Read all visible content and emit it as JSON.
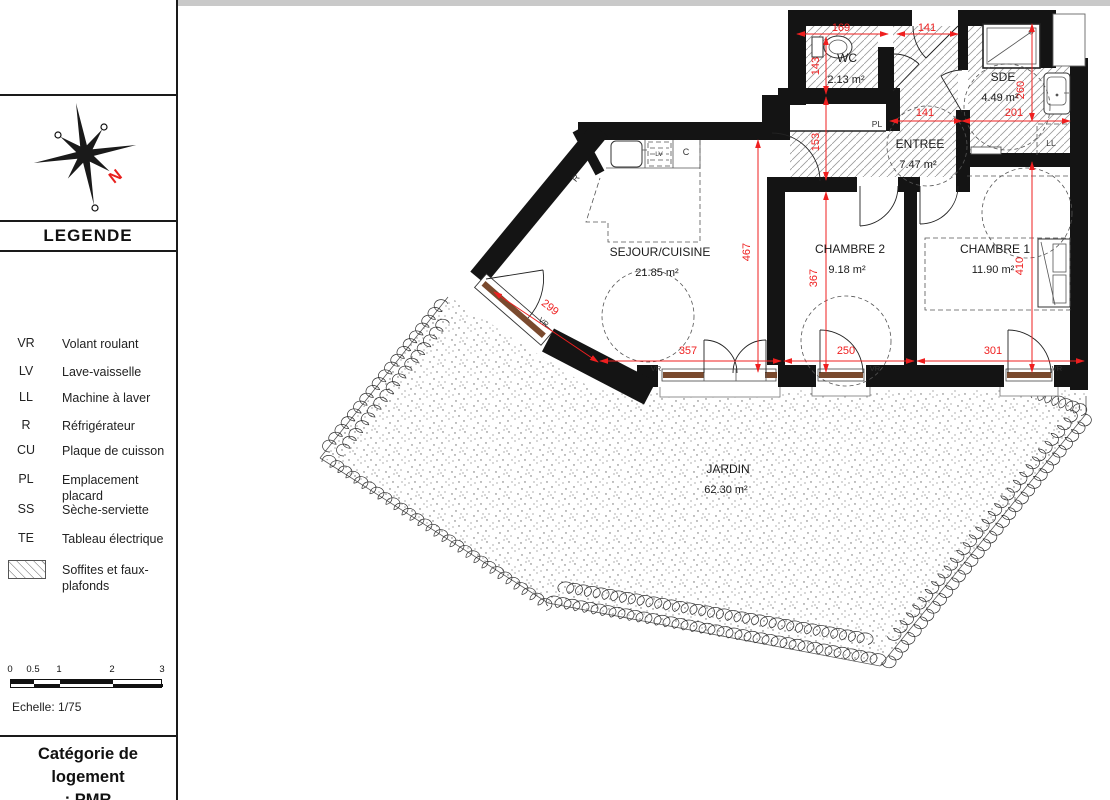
{
  "colors": {
    "dimension_red": "#EF1F1F",
    "wall_black": "#141414",
    "window_frame_brown": "#7A4A2E",
    "hatch_gray": "#999999"
  },
  "sidebar": {
    "legend_title": "LEGENDE",
    "compass_north": "N",
    "items": [
      {
        "abbr": "VR",
        "label": "Volant roulant"
      },
      {
        "abbr": "LV",
        "label": "Lave-vaisselle"
      },
      {
        "abbr": "LL",
        "label": "Machine à laver"
      },
      {
        "abbr": "R",
        "label": "Réfrigérateur"
      },
      {
        "abbr": "CU",
        "label": "Plaque de cuisson"
      },
      {
        "abbr": "PL",
        "label": "Emplacement placard"
      },
      {
        "abbr": "SS",
        "label": "Sèche-serviette"
      },
      {
        "abbr": "TE",
        "label": "Tableau électrique"
      },
      {
        "abbr": "",
        "label": "Soffites et faux-plafonds"
      }
    ],
    "scale": {
      "ticks": [
        "0",
        "0.5",
        "1",
        "2",
        "3"
      ],
      "label": "Echelle: 1/75"
    },
    "category": {
      "line1": "Catégorie de logement",
      "line2": ": PMR"
    }
  },
  "plan": {
    "rooms": {
      "wc": {
        "name": "WC",
        "area": "2.13 m²"
      },
      "sde": {
        "name": "SDE",
        "area": "4.49 m²"
      },
      "entree": {
        "name": "ENTREE",
        "area": "7.47 m²"
      },
      "sejour": {
        "name": "SEJOUR/CUISINE",
        "area": "21.85 m²"
      },
      "chambre2": {
        "name": "CHAMBRE 2",
        "area": "9.18 m²"
      },
      "chambre1": {
        "name": "CHAMBRE 1",
        "area": "11.90 m²"
      },
      "jardin": {
        "name": "JARDIN",
        "area": "62.30 m²"
      }
    },
    "dims": {
      "d169": "169",
      "d141a": "141",
      "d141b": "141",
      "d201": "201",
      "d143": "143",
      "d153": "153",
      "d260": "260",
      "d410": "410",
      "d467": "467",
      "d367": "367",
      "d299": "299",
      "d357": "357",
      "d250": "250",
      "d301": "301"
    },
    "tags": {
      "vr": "VR",
      "pl": "PL",
      "ll": "LL",
      "lv": "LV",
      "cu": "C",
      "r": "R"
    }
  }
}
